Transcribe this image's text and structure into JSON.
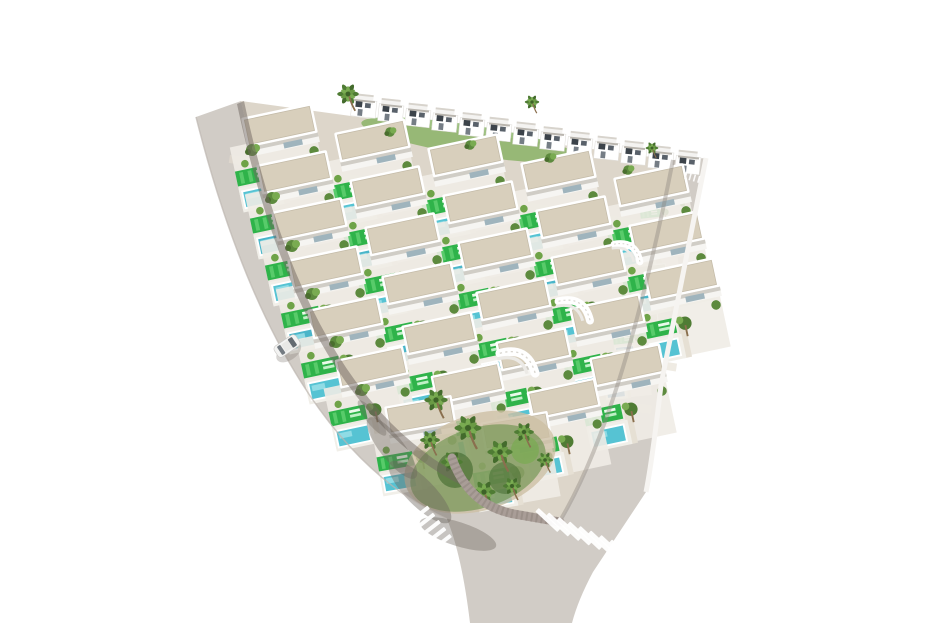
{
  "meta": {
    "description": "3D aerial render of a triangular residential villa development bordered by two roads meeting at a rounded corner with pedestrian crossings",
    "width": 935,
    "height": 623
  },
  "colors": {
    "background": "#ffffff",
    "road": "#d1ccc6",
    "ground": "#ddd6ca",
    "roof_gravel": "#d8cfbc",
    "wall": "#ffffff",
    "lawn": "#2fb34a",
    "lawn_light": "#58cb6a",
    "pool_turquoise": "#56c3d3",
    "pool_blue": "#2f74a8",
    "palm_green": "#4f7c34",
    "palm_light": "#79ab51",
    "shadow": "#6f665f",
    "curb_brick": "#a99d97",
    "crosswalk_stripe": "#ffffff",
    "car_body": "#f3f3f2",
    "car_glass": "#646b72"
  },
  "scene": {
    "back_row": {
      "symbol": "bhouse",
      "x": 352,
      "y": 93,
      "n": 13,
      "dx": 27,
      "dy": 4.7,
      "s": 0.95,
      "r": 6
    },
    "villa_rows": [
      {
        "x": 222,
        "y": 120,
        "n": 5,
        "dx": 93,
        "dy": 15,
        "s": 0.95,
        "r": -12,
        "pool": "#56c3d3"
      },
      {
        "x": 237,
        "y": 167,
        "n": 5,
        "dx": 93,
        "dy": 15,
        "s": 0.95,
        "r": -12,
        "pool": "#4ab5c9"
      },
      {
        "x": 252,
        "y": 214,
        "n": 5,
        "dx": 93,
        "dy": 15,
        "s": 0.95,
        "r": -12,
        "pool": "#56c3d3"
      },
      {
        "x": 268,
        "y": 262,
        "n": 4,
        "dx": 94,
        "dy": 16,
        "s": 0.95,
        "r": -12,
        "pool": "#4ab5c9"
      },
      {
        "x": 288,
        "y": 312,
        "n": 4,
        "dx": 94,
        "dy": 16,
        "s": 0.95,
        "r": -12,
        "pool": "#56c3d3"
      },
      {
        "x": 316,
        "y": 362,
        "n": 3,
        "dx": 96,
        "dy": 16,
        "s": 0.92,
        "r": -12,
        "pool": "#56c3d3"
      },
      {
        "x": 366,
        "y": 408,
        "n": 2,
        "dx": 96,
        "dy": 16,
        "s": 0.9,
        "r": -10,
        "pool": "#56c3d3"
      }
    ],
    "right_column": {
      "x": 636,
      "y": 183,
      "n": 5,
      "dx": -9,
      "dy": 42,
      "s": 0.5,
      "r": -6,
      "pool": "#2f74a8"
    },
    "stairs": [
      {
        "x": 497,
        "y": 352,
        "r": -20,
        "s": 1.1
      },
      {
        "x": 556,
        "y": 300,
        "r": -18,
        "s": 1.0
      },
      {
        "x": 612,
        "y": 243,
        "r": -15,
        "s": 0.85
      }
    ],
    "palms": [
      {
        "x": 348,
        "y": 94,
        "s": 1.2
      },
      {
        "x": 532,
        "y": 102,
        "s": 0.8
      },
      {
        "x": 652,
        "y": 148,
        "s": 0.7
      },
      {
        "x": 436,
        "y": 400,
        "s": 1.3
      },
      {
        "x": 468,
        "y": 428,
        "s": 1.5
      },
      {
        "x": 500,
        "y": 452,
        "s": 1.4
      },
      {
        "x": 452,
        "y": 462,
        "s": 1.2
      },
      {
        "x": 524,
        "y": 432,
        "s": 1.1
      },
      {
        "x": 484,
        "y": 492,
        "s": 1.3
      },
      {
        "x": 430,
        "y": 440,
        "s": 1.1
      },
      {
        "x": 512,
        "y": 486,
        "s": 1.0
      },
      {
        "x": 545,
        "y": 460,
        "s": 0.9
      }
    ],
    "bushes": [
      {
        "x": 252,
        "y": 150,
        "s": 1
      },
      {
        "x": 272,
        "y": 198,
        "s": 1
      },
      {
        "x": 292,
        "y": 246,
        "s": 1
      },
      {
        "x": 312,
        "y": 294,
        "s": 1
      },
      {
        "x": 336,
        "y": 342,
        "s": 1
      },
      {
        "x": 362,
        "y": 390,
        "s": 1
      },
      {
        "x": 390,
        "y": 132,
        "s": 0.8
      },
      {
        "x": 470,
        "y": 145,
        "s": 0.8
      },
      {
        "x": 550,
        "y": 158,
        "s": 0.8
      },
      {
        "x": 628,
        "y": 170,
        "s": 0.8
      }
    ],
    "crosswalk_left": {
      "x": 414,
      "y": 516,
      "r": 52,
      "stripes": 5,
      "step": 9,
      "w": 4,
      "len": 34
    },
    "crosswalk_right": {
      "x": 548,
      "y": 520,
      "r": 8,
      "stripes": 8,
      "step": 11,
      "dy": 3,
      "w": 5,
      "len": 30,
      "bar_r": -55
    },
    "road_dashes": {
      "x": 686,
      "y": 172,
      "r": 16,
      "n": 4,
      "step": 4.5
    },
    "car": {
      "x": 287,
      "y": 346,
      "r": 56
    }
  }
}
